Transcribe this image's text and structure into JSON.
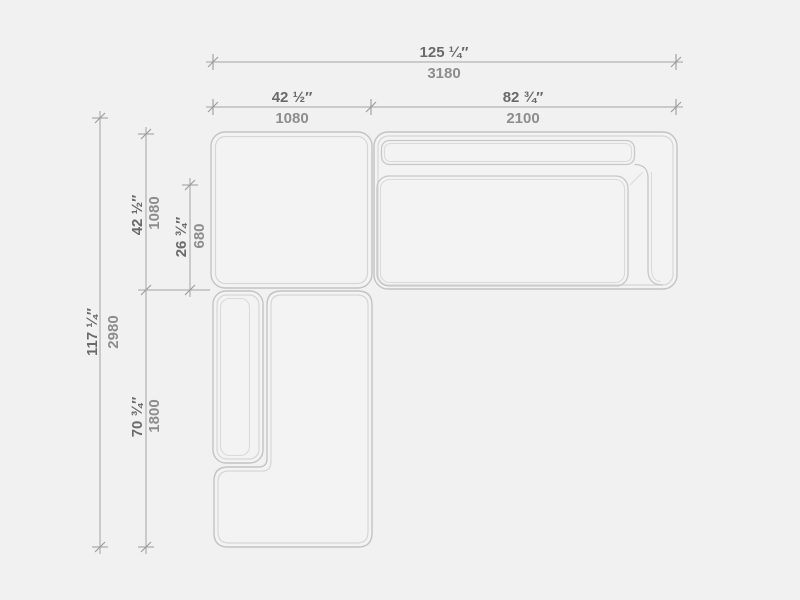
{
  "drawing": {
    "type": "furniture-top-view-dimension-drawing",
    "background_color": "#f1f1f1",
    "outline_color": "#c3c3c3",
    "inner_outline_color": "#d6d6d6",
    "dimension_line_color": "#a3a3a3",
    "inch_text_color": "#6a6a6a",
    "mm_text_color": "#8d8d8d",
    "modules": [
      "corner-ottoman-module",
      "sofa-module-right-armrest",
      "chaise-module-left-armrest"
    ]
  },
  "dims": {
    "top_total": {
      "inches": "125 ¼″",
      "mm": "3180"
    },
    "top_left": {
      "inches": "42 ½″",
      "mm": "1080"
    },
    "top_right": {
      "inches": "82 ¾″",
      "mm": "2100"
    },
    "left_total": {
      "inches": "117 ¼″",
      "mm": "2980"
    },
    "left_upper": {
      "inches": "42 ½″",
      "mm": "1080"
    },
    "left_seat": {
      "inches": "26 ¾″",
      "mm": "680"
    },
    "left_lower": {
      "inches": "70 ¾″",
      "mm": "1800"
    }
  }
}
